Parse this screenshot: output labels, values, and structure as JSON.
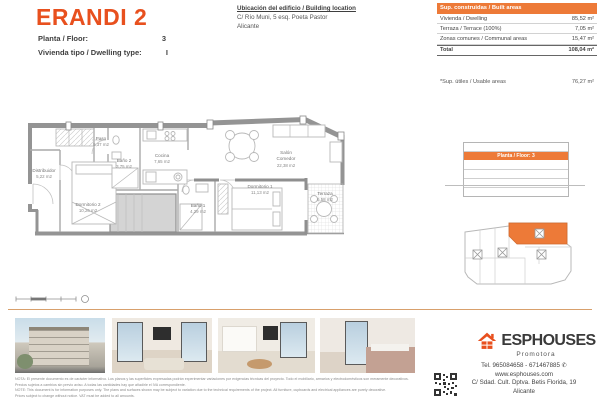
{
  "header": {
    "title": "ERANDI 2",
    "floor_label": "Planta / Floor:",
    "floor_value": "3",
    "type_label": "Vivienda tipo / Dwelling type:",
    "type_value": "I",
    "location_heading": "Ubicación del edificio / Building location",
    "location_line1": "C/ Río Muni, 5 esq. Poeta Pastor",
    "location_line2": "Alicante"
  },
  "areas_table": {
    "header": "Sup. construidas / Built areas",
    "rows": [
      {
        "label": "Vivienda / Dwelling",
        "value": "85,52 m²"
      },
      {
        "label": "Terraza / Terrace (100%)",
        "value": "7,05 m²"
      },
      {
        "label": "Zonas comunes / Communal areas",
        "value": "15,47 m²"
      }
    ],
    "total_label": "Total",
    "total_value": "108,04 m²",
    "usable_label": "*Sup. útiles / Usable areas",
    "usable_value": "76,27 m²"
  },
  "floor_plan": {
    "rooms": [
      {
        "name": "Distribuidor",
        "area": "5,22 m2"
      },
      {
        "name": "Paso",
        "area": "5,37 m2"
      },
      {
        "name": "Baño 2",
        "area": "3,75 m2"
      },
      {
        "name": "Cocina",
        "area": "7,65 m2"
      },
      {
        "name": "Salón",
        "name2": "Comedor",
        "area": "22,38 m2"
      },
      {
        "name": "Baño 1",
        "area": "4,29 m2"
      },
      {
        "name": "Dormitorio 1",
        "area": "11,13 m2"
      },
      {
        "name": "Dormitorio 2",
        "area": "10,26 m2"
      },
      {
        "name": "Terraza",
        "area": "6,58 m2"
      }
    ]
  },
  "elevation": {
    "label": "Planta / Floor: 3"
  },
  "footer": {
    "brand": "ESPHOUSES",
    "brand_sub": "Promotora",
    "phone": "Tel. 965084658 - 671467885",
    "website": "www.esphouses.com",
    "address": "C/ Sdad. Cult. Dptva. Betis Florida, 19",
    "city": "Alicante",
    "legal_es1": "NOTA: El presente documento es de carácter informativo. Los planos y las superficies expresadas podrán experimentar variaciones por exigencias técnicas del proyecto. Todo el mobiliario, armarios y electrodomésticos son meramente decorativos.",
    "legal_es2": "Precios sujetos a cambios sin previo aviso. A todas las cantidades hay que añadirle el IVA correspondiente.",
    "legal_en1": "NOTE: This document is for information purposes only. The plans and surfaces shown may be subject to variation due to the technical requirements of the project. All furniture, cupboards and electrical appliances are purely decorative.",
    "legal_en2": "Prices subject to change without notice. VAT must be added to all amounts."
  },
  "colors": {
    "accent": "#E8501E",
    "table_header": "#ED7A38"
  }
}
